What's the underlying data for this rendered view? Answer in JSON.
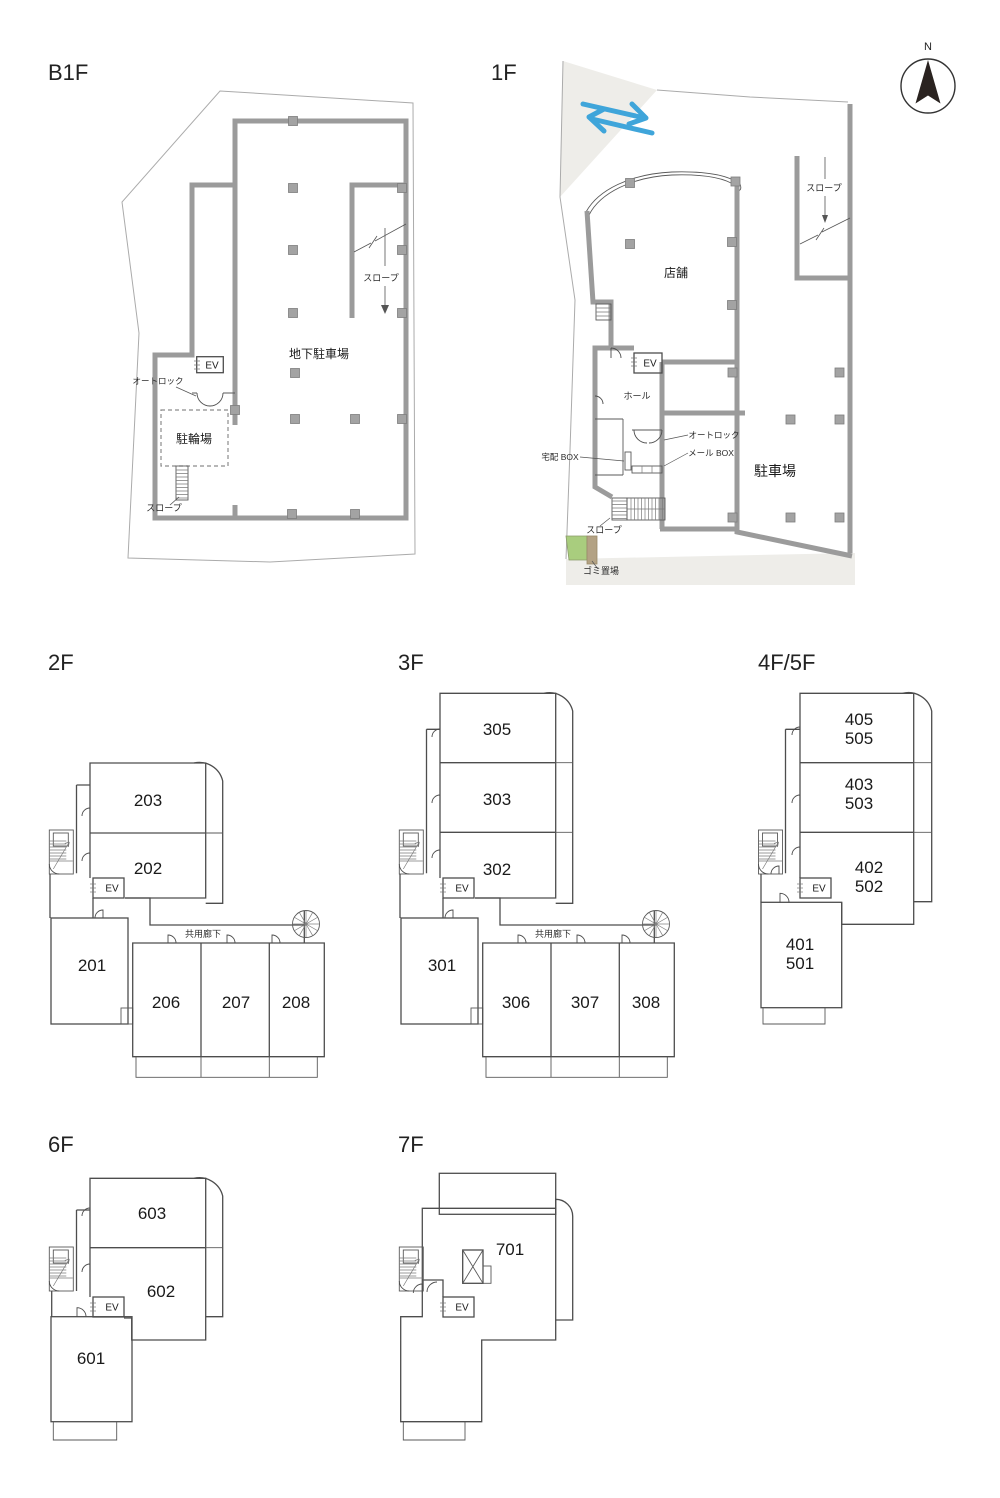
{
  "compass": {
    "north": "N"
  },
  "colors": {
    "wall": "#9b9b9b",
    "line": "#4d4d4d",
    "road": "#eeede9",
    "arrow_blue": "#3fa5da",
    "garbage_green": "#a9cd7e",
    "garbage_tan": "#b3a284"
  },
  "floors": {
    "b1f": {
      "title": "B1F",
      "parking": "地下駐車場",
      "bicycle": "駐輪場",
      "ev": "EV",
      "autolock": "オートロック",
      "slope_ramp": "スロープ",
      "slope_side": "スロープ"
    },
    "f1": {
      "title": "1F",
      "shop": "店舗",
      "parking": "駐車場",
      "hall": "ホール",
      "ev": "EV",
      "autolock": "オートロック",
      "mailbox": "メール BOX",
      "delivery_box": "宅配 BOX",
      "slope_ramp": "スロープ",
      "slope_side": "スロープ",
      "garbage": "ゴミ置場"
    },
    "f2": {
      "title": "2F",
      "ev": "EV",
      "corridor": "共用廊下",
      "r201": "201",
      "r202": "202",
      "r203": "203",
      "r206": "206",
      "r207": "207",
      "r208": "208"
    },
    "f3": {
      "title": "3F",
      "ev": "EV",
      "corridor": "共用廊下",
      "r301": "301",
      "r302": "302",
      "r303": "303",
      "r305": "305",
      "r306": "306",
      "r307": "307",
      "r308": "308"
    },
    "f45": {
      "title": "4F/5F",
      "ev": "EV",
      "r401": "401",
      "r501": "501",
      "r402": "402",
      "r502": "502",
      "r403": "403",
      "r503": "503",
      "r405": "405",
      "r505": "505"
    },
    "f6": {
      "title": "6F",
      "ev": "EV",
      "r601": "601",
      "r602": "602",
      "r603": "603"
    },
    "f7": {
      "title": "7F",
      "ev": "EV",
      "r701": "701"
    }
  }
}
